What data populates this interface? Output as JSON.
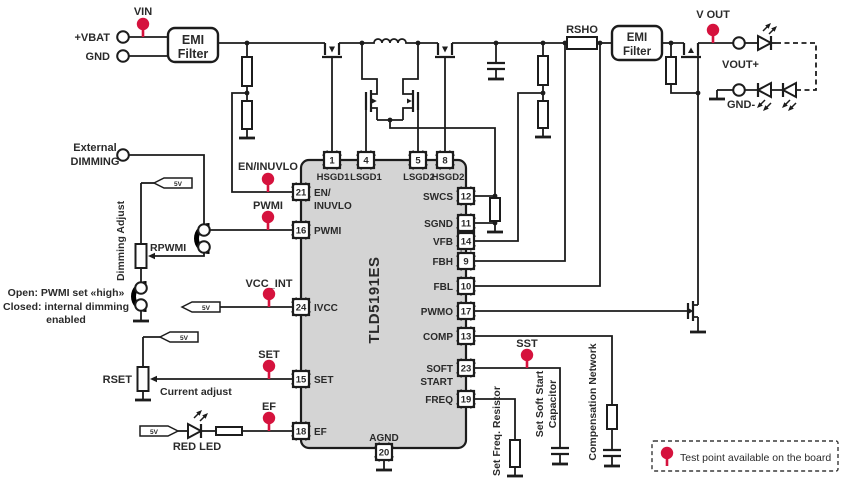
{
  "colors": {
    "accent_red": "#d5123d",
    "ic_fill": "#d4d4d4",
    "wire": "#1c1c1c",
    "text": "#2a2a2a"
  },
  "source": {
    "vin_tp": "VIN",
    "vbat": "+VBAT",
    "gnd": "GND",
    "emi_line1": "EMI",
    "emi_line2": "Filter"
  },
  "output": {
    "rsho": "RSHO",
    "emi_line1": "EMI",
    "emi_line2": "Filter",
    "vout_tp": "V OUT",
    "vout_plus": "VOUT+",
    "gnd_minus": "GND-"
  },
  "dimming": {
    "external_line1": "External",
    "external_line2": "DIMMING",
    "adjust": "Dimming Adjust",
    "rpwmi": "RPWMI",
    "note1": "Open: PWMI set «high»",
    "note2": "Closed: internal dimming",
    "note3": "enabled"
  },
  "analog": {
    "rset": "RSET",
    "current_adjust": "Current adjust",
    "red_led": "RED LED"
  },
  "tp": {
    "en_inuvlo": "EN/INUVLO",
    "pwmi": "PWMI",
    "vcc_int": "VCC_INT",
    "set": "SET",
    "ef": "EF",
    "sst": "SST"
  },
  "ic": {
    "name": "TLD5191ES",
    "pins": [
      {
        "num": "1",
        "label": "HSGD1"
      },
      {
        "num": "4",
        "label": "LSGD1"
      },
      {
        "num": "5",
        "label": "LSGD2"
      },
      {
        "num": "8",
        "label": "HSGD2"
      },
      {
        "num": "21",
        "label1": "EN/",
        "label2": "INUVLO"
      },
      {
        "num": "16",
        "label": "PWMI"
      },
      {
        "num": "24",
        "label": "IVCC"
      },
      {
        "num": "15",
        "label": "SET"
      },
      {
        "num": "18",
        "label": "EF"
      },
      {
        "num": "12",
        "label": "SWCS"
      },
      {
        "num": "11",
        "label": "SGND"
      },
      {
        "num": "14",
        "label": "VFB"
      },
      {
        "num": "9",
        "label": "FBH"
      },
      {
        "num": "10",
        "label": "FBL"
      },
      {
        "num": "17",
        "label": "PWMO"
      },
      {
        "num": "13",
        "label": "COMP"
      },
      {
        "num": "23",
        "label1": "SOFT",
        "label2": "START"
      },
      {
        "num": "19",
        "label": "FREQ"
      },
      {
        "num": "20",
        "label": "AGND"
      }
    ]
  },
  "networks": {
    "set_freq": "Set Freq. Resistor",
    "soft_start1": "Set Soft Start",
    "soft_start2": "Capacitor",
    "compensation": "Compensation Network"
  },
  "legend": {
    "text": "Test point available on the board"
  },
  "misc": {
    "flag_5v": "5V"
  }
}
